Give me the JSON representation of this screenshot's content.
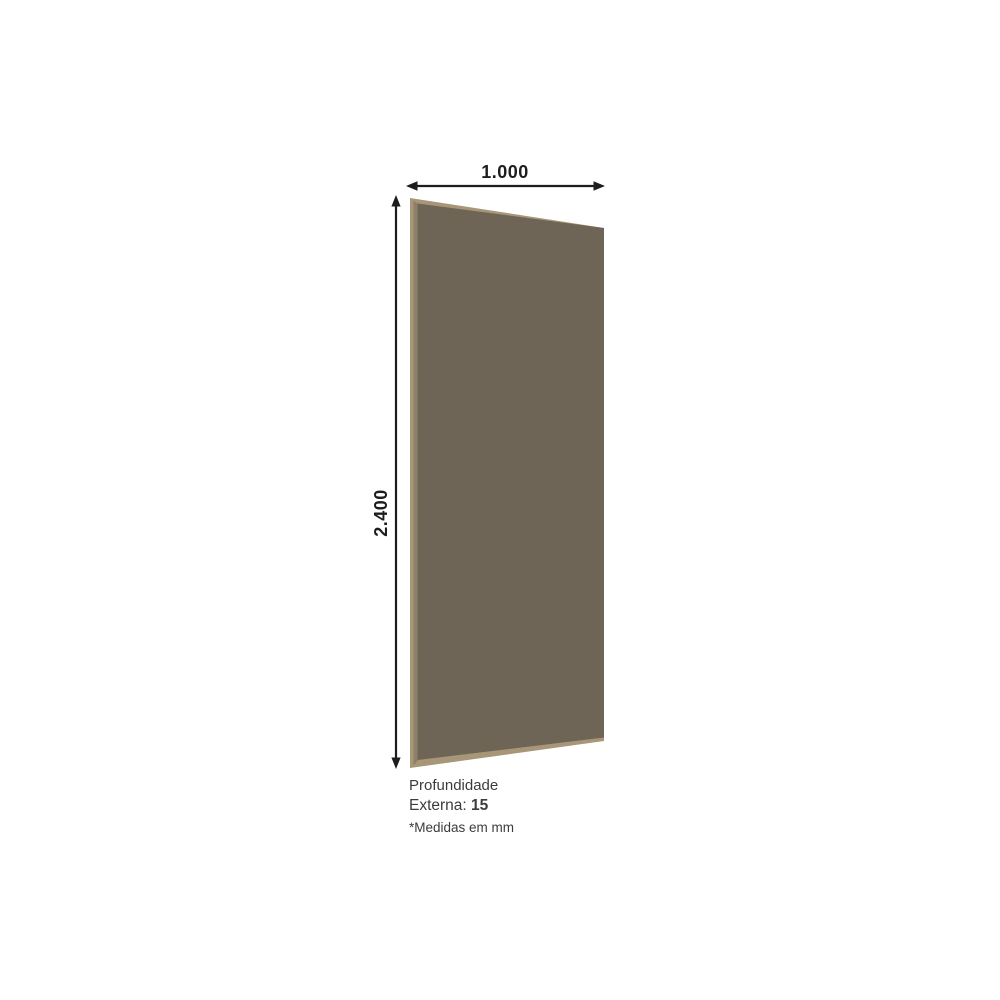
{
  "colors": {
    "background": "#ffffff",
    "panel_face": "#6f6557",
    "panel_edge_light": "#a89678",
    "panel_edge_mid": "#8d7f6a",
    "dimension_line": "#1d1d1b",
    "caption_text": "#3c3c3c"
  },
  "dimensions": {
    "width_label": "1.000",
    "height_label": "2.400"
  },
  "caption": {
    "line1": "Profundidade",
    "line2_label": "Externa:",
    "line2_value": "15",
    "footnote": "*Medidas em mm"
  }
}
